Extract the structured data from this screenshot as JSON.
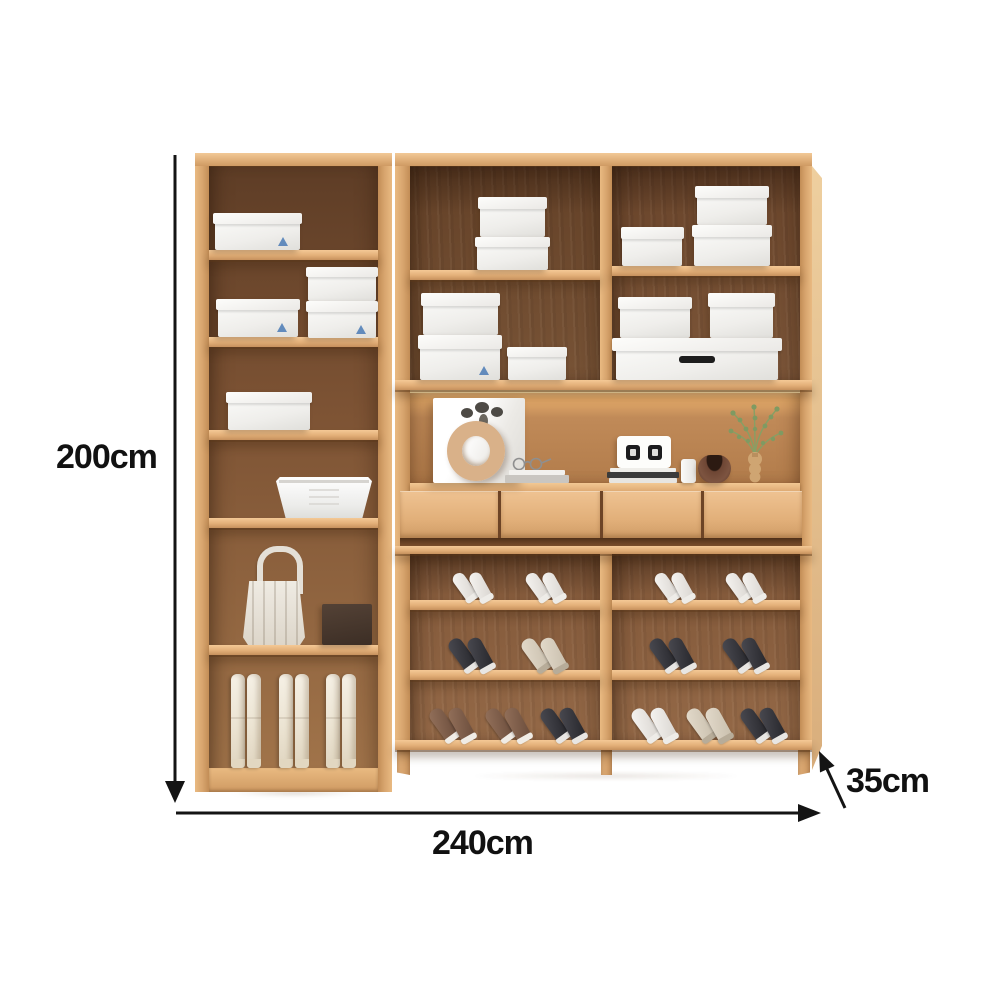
{
  "annotations": {
    "height": "200cm",
    "width": "240cm",
    "depth": "35cm"
  },
  "colors": {
    "annotation_line": "#141414",
    "wood_frame": "#d9a272",
    "wood_shelf": "#e5b583",
    "wood_interior_dark": "#6f4a2e",
    "wood_interior_light": "#a1744a",
    "display_back": "#bc8654",
    "led_glow": "#f9cf8f",
    "drawer_front": "#e2b07a",
    "box_white": "#f3f2f0",
    "logo_blue": "#4a7ab5",
    "shoe_white": "#f2f0ed",
    "shoe_black": "#35353a",
    "shoe_brown": "#8a6a55",
    "shoe_cream": "#d9cfc0",
    "boot_cream": "#efe9dd",
    "handbag_cream": "#e8e4dc",
    "gift_box_brown": "#4b3a2f"
  },
  "cabinet": {
    "left_bookcase": {
      "compartments": 6,
      "contents": [
        "storage-box",
        "stacked-storage-boxes",
        "storage-box",
        "storage-basket",
        "handbag-and-gift-box",
        "boots"
      ]
    },
    "right_unit": {
      "upper_box_shelves": 4,
      "display_niche": [
        "photo-frame",
        "donut-vase",
        "dried-plant",
        "books",
        "glasses",
        "digital-clock",
        "canister",
        "bowl",
        "green-plant"
      ],
      "drawers": 4,
      "shoe_rows": 3
    }
  },
  "shoe_shelves": {
    "mid": [
      [
        "white",
        "white"
      ],
      [
        "black",
        "cream"
      ],
      [
        "brown",
        "brown",
        "black"
      ]
    ],
    "right": [
      [
        "white",
        "white"
      ],
      [
        "black",
        "black"
      ],
      [
        "white",
        "cream",
        "black"
      ]
    ]
  },
  "boots": {
    "pairs": 3
  }
}
